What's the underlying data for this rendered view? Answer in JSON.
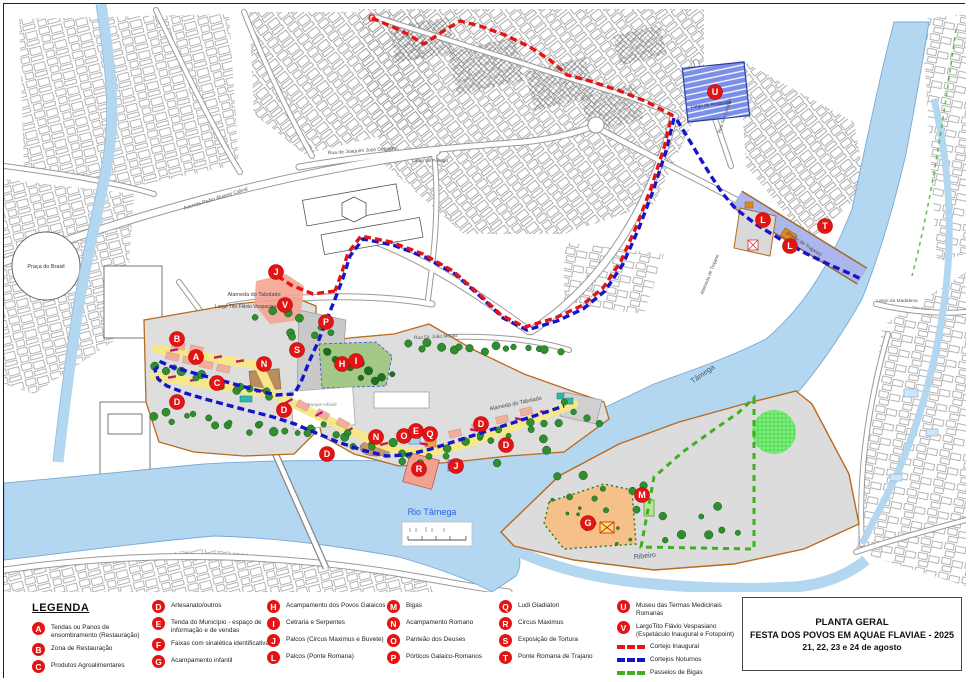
{
  "title_block": {
    "line1": "PLANTA GERAL",
    "line2": "FESTA DOS POVOS EM AQUAE FLAVIAE - 2025",
    "line3": "21, 22, 23 e 24 de agosto"
  },
  "legend": {
    "heading": "LEGENDA",
    "columns": [
      [
        {
          "letter": "A",
          "label": "Tendas ou Panos de ensombramento (Restauração)"
        },
        {
          "letter": "B",
          "label": "Zona de Restauração"
        },
        {
          "letter": "C",
          "label": "Produtos Agroalimentares"
        }
      ],
      [
        {
          "letter": "D",
          "label": "Artesanato/outros"
        },
        {
          "letter": "E",
          "label": "Tenda do Município - espaço de informação e de vendas"
        },
        {
          "letter": "F",
          "label": "Faixas com sinalética identificativa"
        },
        {
          "letter": "G",
          "label": "Acampamento infantil"
        }
      ],
      [
        {
          "letter": "H",
          "label": "Acampamento dos Povos Galaicos"
        },
        {
          "letter": "I",
          "label": "Cetraria e Serpentes"
        },
        {
          "letter": "J",
          "label": "Palcos (Circus Maximus e Buvete)"
        },
        {
          "letter": "L",
          "label": "Palcos (Ponte Romana)"
        }
      ],
      [
        {
          "letter": "M",
          "label": "Bigas"
        },
        {
          "letter": "N",
          "label": "Acampamento Romano"
        },
        {
          "letter": "O",
          "label": "Panteão dos Deuses"
        },
        {
          "letter": "P",
          "label": "Pórticos Galaico-Romanos"
        }
      ],
      [
        {
          "letter": "Q",
          "label": "Ludi Gladiatori"
        },
        {
          "letter": "R",
          "label": "Circus Maximus"
        },
        {
          "letter": "S",
          "label": "Exposição de Tortura"
        },
        {
          "letter": "T",
          "label": "Ponte Romana de Trajano"
        }
      ],
      [
        {
          "letter": "U",
          "label": "Museu das Termas Medicinais Romanas"
        },
        {
          "letter": "V",
          "label": "LargoTito Flávio Vespasiano (Espetáculo Inaugural e Fotopoint)"
        }
      ]
    ],
    "routes": [
      {
        "name": "Cortejo Inaugural",
        "color": "#e51414"
      },
      {
        "name": "Cortejos Noturnos",
        "color": "#1414cc"
      },
      {
        "name": "Passeios de Bigas",
        "color": "#3faf1f"
      }
    ]
  },
  "map": {
    "colors": {
      "river": "#b3d7f0",
      "river_edge": "#7aa8d6",
      "route_red": "#e51414",
      "route_blue": "#1414cc",
      "route_green": "#3faf1f",
      "marker": "#e51414",
      "festival_boundary": "#b86b1e",
      "yellow_band": "#f6e88a",
      "parking_blue": "#7b8fe8"
    },
    "markers": [
      {
        "letter": "B",
        "x": 173,
        "y": 335
      },
      {
        "letter": "A",
        "x": 192,
        "y": 353
      },
      {
        "letter": "C",
        "x": 213,
        "y": 379
      },
      {
        "letter": "D",
        "x": 173,
        "y": 398
      },
      {
        "letter": "D",
        "x": 280,
        "y": 406
      },
      {
        "letter": "D",
        "x": 323,
        "y": 450
      },
      {
        "letter": "D",
        "x": 477,
        "y": 420
      },
      {
        "letter": "D",
        "x": 502,
        "y": 441
      },
      {
        "letter": "N",
        "x": 260,
        "y": 360
      },
      {
        "letter": "S",
        "x": 293,
        "y": 346
      },
      {
        "letter": "P",
        "x": 322,
        "y": 318
      },
      {
        "letter": "H",
        "x": 338,
        "y": 360
      },
      {
        "letter": "I",
        "x": 352,
        "y": 357
      },
      {
        "letter": "N",
        "x": 372,
        "y": 433
      },
      {
        "letter": "O",
        "x": 400,
        "y": 432
      },
      {
        "letter": "E",
        "x": 412,
        "y": 427
      },
      {
        "letter": "Q",
        "x": 426,
        "y": 430
      },
      {
        "letter": "R",
        "x": 415,
        "y": 465
      },
      {
        "letter": "J",
        "x": 452,
        "y": 462
      },
      {
        "letter": "J",
        "x": 272,
        "y": 268
      },
      {
        "letter": "V",
        "x": 281,
        "y": 301
      },
      {
        "letter": "G",
        "x": 584,
        "y": 519
      },
      {
        "letter": "M",
        "x": 638,
        "y": 491
      },
      {
        "letter": "U",
        "x": 711,
        "y": 88
      },
      {
        "letter": "L",
        "x": 759,
        "y": 216
      },
      {
        "letter": "L",
        "x": 786,
        "y": 242
      },
      {
        "letter": "T",
        "x": 821,
        "y": 222
      }
    ],
    "labels": [
      {
        "text": "Praça do Brasil",
        "x": 42,
        "y": 264,
        "size": 5.5,
        "color": "#333",
        "rotate": 0
      },
      {
        "text": "Avenida Pedro Álvares Cabral",
        "x": 212,
        "y": 196,
        "size": 5,
        "color": "#555",
        "rotate": -17
      },
      {
        "text": "Rua de Joaquim José Delgado",
        "x": 358,
        "y": 148,
        "size": 5,
        "color": "#555",
        "rotate": -4
      },
      {
        "text": "Largo do Postigo",
        "x": 426,
        "y": 158,
        "size": 4.8,
        "color": "#555",
        "rotate": 0
      },
      {
        "text": "Rua das Longras",
        "x": 722,
        "y": 112,
        "size": 4.8,
        "color": "#555",
        "rotate": -72
      },
      {
        "text": "Largo do Arrabalde",
        "x": 707,
        "y": 102,
        "size": 4.8,
        "color": "#15246b",
        "rotate": -6
      },
      {
        "text": "(Ponte de Trajano)",
        "x": 799,
        "y": 241,
        "size": 5,
        "color": "#444",
        "rotate": 33
      },
      {
        "text": "Alameda de Trajano",
        "x": 707,
        "y": 271,
        "size": 4.8,
        "color": "#555",
        "rotate": -68
      },
      {
        "text": "Largo da Madalena",
        "x": 893,
        "y": 298,
        "size": 4.8,
        "color": "#555",
        "rotate": 0
      },
      {
        "text": "Rua Dr. João Morais",
        "x": 432,
        "y": 334,
        "size": 4.8,
        "color": "#555",
        "rotate": -3
      },
      {
        "text": "Alameda do Tabolado",
        "x": 250,
        "y": 292,
        "size": 5.5,
        "color": "#444",
        "rotate": 0
      },
      {
        "text": "Alameda do Tabolado",
        "x": 512,
        "y": 401,
        "size": 5.5,
        "color": "#444",
        "rotate": -12
      },
      {
        "text": "Largo Tito Flávio Vespasiano",
        "x": 243,
        "y": 304,
        "size": 5,
        "color": "#444",
        "rotate": 0
      },
      {
        "text": "Parque Infantil",
        "x": 318,
        "y": 402,
        "size": 4.5,
        "color": "#888",
        "rotate": 0
      },
      {
        "text": "Rio Tâmega",
        "x": 428,
        "y": 511,
        "size": 9,
        "color": "#2b62d9",
        "rotate": 0
      },
      {
        "text": "Tâmega",
        "x": 700,
        "y": 372,
        "size": 7.5,
        "color": "#44556a",
        "rotate": -35
      },
      {
        "text": "Ribeiro",
        "x": 641,
        "y": 554,
        "size": 7,
        "color": "#44556a",
        "rotate": -6
      }
    ]
  }
}
